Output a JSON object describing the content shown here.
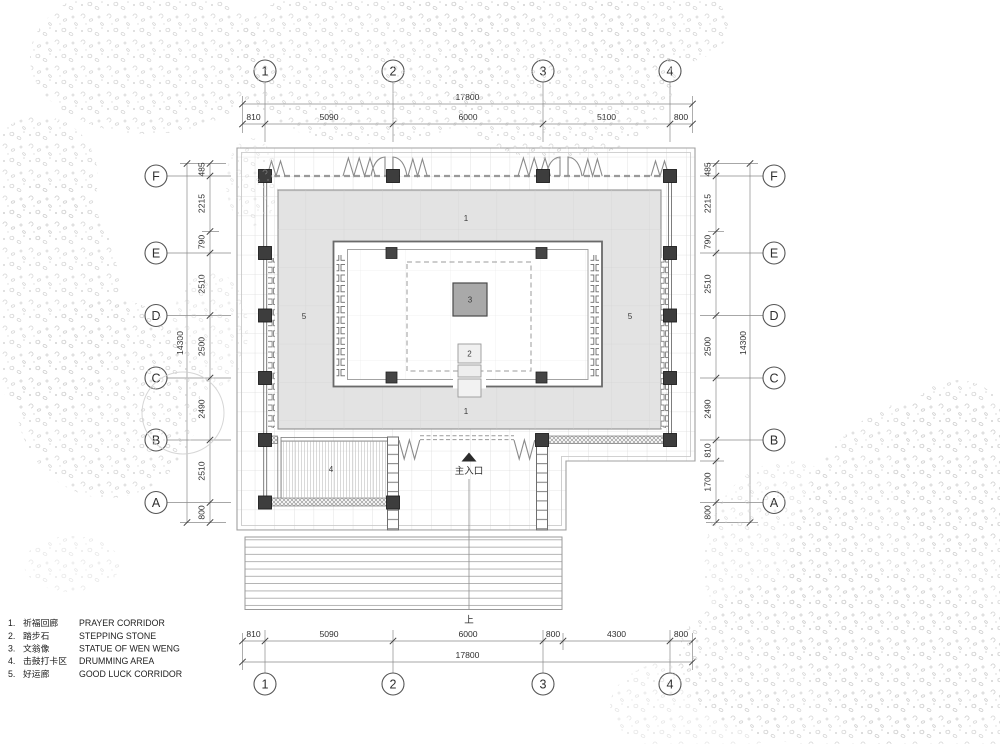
{
  "grid_bubbles": {
    "cols": [
      "1",
      "2",
      "3",
      "4"
    ],
    "rows": [
      "F",
      "E",
      "D",
      "C",
      "B",
      "A"
    ]
  },
  "dimensions": {
    "top": {
      "overall": "17800",
      "segments": [
        "810",
        "5090",
        "6000",
        "5100",
        "800"
      ]
    },
    "bottom": {
      "overall": "17800",
      "segments": [
        "810",
        "5090",
        "6000",
        "800",
        "4300",
        "800"
      ]
    },
    "left": {
      "overall": "14300",
      "segments": [
        "485",
        "2215",
        "790",
        "2510",
        "2500",
        "2490",
        "2510",
        "800"
      ]
    },
    "right": {
      "overall": "14300",
      "segments": [
        "485",
        "2215",
        "790",
        "2510",
        "2500",
        "2490",
        "810",
        "1700",
        "800"
      ]
    }
  },
  "plan": {
    "area_labels": {
      "prayer_corridor": "1",
      "stepping_stone": "2",
      "statue": "3",
      "drumming_area": "4",
      "good_luck_corridor": "5"
    },
    "entrance_label": "主入口",
    "stair_direction_label": "上"
  },
  "legend": {
    "items": [
      {
        "no": "1.",
        "zh": "祈福回廊",
        "en": "PRAYER CORRIDOR"
      },
      {
        "no": "2.",
        "zh": "踏步石",
        "en": "STEPPING STONE"
      },
      {
        "no": "3.",
        "zh": "文翁像",
        "en": "STATUE OF WEN WENG"
      },
      {
        "no": "4.",
        "zh": "击鼓打卡区",
        "en": "DRUMMING AREA"
      },
      {
        "no": "5.",
        "zh": "好运廊",
        "en": "GOOD LUCK CORRIDOR"
      }
    ]
  },
  "colors": {
    "corridor_fill": "#e3e3e3",
    "hall_fill": "#ffffff",
    "column": "#3d3d3d",
    "statue_fill": "#a9a9a9",
    "dimension_text": "#2e2e2e"
  }
}
